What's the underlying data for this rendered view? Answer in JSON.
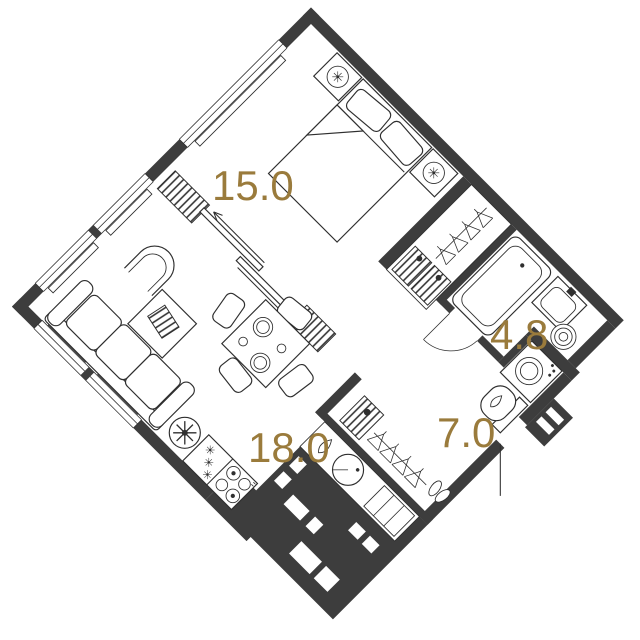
{
  "plan": {
    "type": "apartment-floor-plan",
    "orientation_deg": 45,
    "area_unit": "m2",
    "colors": {
      "wall": "#3d3d3d",
      "line": "#2f2f2f",
      "label": "#9a7b3c",
      "background": "#ffffff"
    },
    "rooms": [
      {
        "id": "bedroom",
        "area": "15.0"
      },
      {
        "id": "living-kitchen",
        "area": "18.0"
      },
      {
        "id": "bathroom",
        "area": "4.8"
      },
      {
        "id": "hallway",
        "area": "7.0"
      }
    ],
    "fixtures": {
      "bedroom": [
        "double-bed",
        "pillows",
        "nightstand-with-lamp",
        "nightstand-with-lamp",
        "wardrobe-hangers",
        "shelf-boxes",
        "sliding-partition",
        "window"
      ],
      "bathroom": [
        "bathtub",
        "washbasin",
        "towel-dryer",
        "door"
      ],
      "hallway": [
        "washing-machine",
        "toilet",
        "closet-hangers",
        "shoe-pair",
        "drawer-with-plant",
        "entry-door"
      ],
      "living-kitchen": [
        "sofa",
        "armchair",
        "coffee-table-with-magazine",
        "dining-table",
        "chairs",
        "plates",
        "floor-lamp",
        "dishwasher",
        "cooktop-4-burners",
        "round-sink",
        "kettle",
        "kitchen-counter",
        "window",
        "vent-shafts"
      ]
    }
  }
}
